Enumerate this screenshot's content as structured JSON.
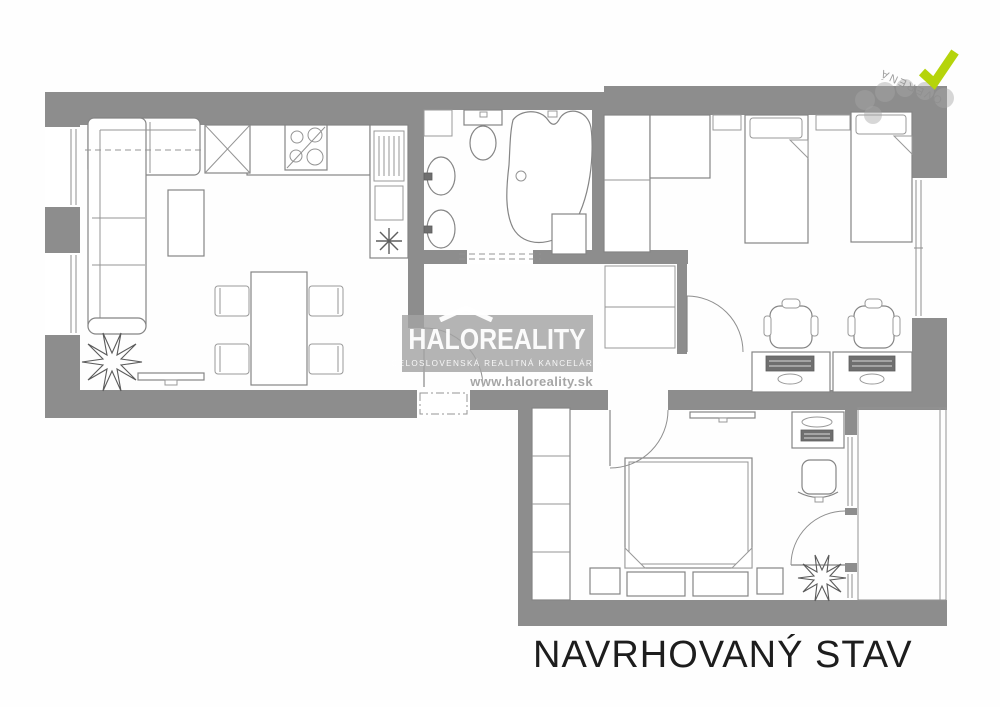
{
  "plan": {
    "caption": "NAVRHOVANÝ STAV",
    "wall_color": "#8d8d8d",
    "line_color": "#858585",
    "background": "#ffffff"
  },
  "watermark": {
    "brand": "HALOREALITY",
    "tagline": "CELOSLOVENSKÁ REALITNÁ KANCELÁRIA",
    "url": "www.haloreality.sk",
    "roof_icon": "house-roof-icon",
    "bg_color": "rgba(163,163,163,0.82)"
  },
  "badge": {
    "check_icon": "check-icon",
    "check_color": "#b5d40b",
    "stamp_text": "OVERENÁ",
    "stamp_color": "#8f8f8f"
  }
}
